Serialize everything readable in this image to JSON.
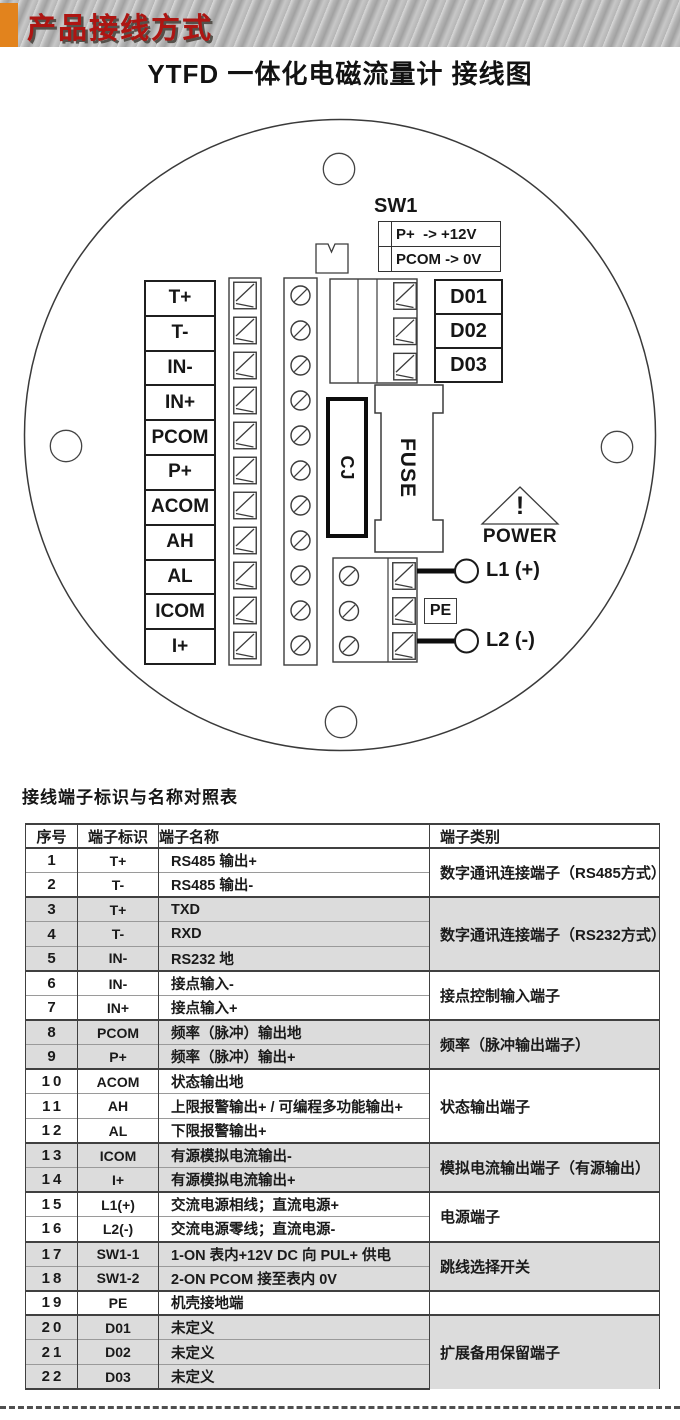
{
  "banner": {
    "title": "产品接线方式",
    "accent_color": "#e2831d",
    "title_color": "#ae1512"
  },
  "doc_title": "YTFD 一体化电磁流量计 接线图",
  "diagram": {
    "sw1": {
      "label": "SW1",
      "rows": [
        "P+  -> +12V",
        "PCOM -> 0V"
      ]
    },
    "left_terminals": [
      "T+",
      "T-",
      "IN-",
      "IN+",
      "PCOM",
      "P+",
      "ACOM",
      "AH",
      "AL",
      "ICOM",
      "I+"
    ],
    "relay_outputs": [
      "D01",
      "D02",
      "D03"
    ],
    "cj_label": "CJ",
    "fuse_label": "FUSE",
    "power_warning": {
      "exclamation": "!",
      "label": "POWER"
    },
    "power_terminals": {
      "l1": "L1 (+)",
      "pe": "PE",
      "l2": "L2 (-)"
    }
  },
  "table": {
    "heading": "接线端子标识与名称对照表",
    "columns": [
      "序号",
      "端子标识",
      "端子名称",
      "端子类别"
    ],
    "rows": [
      {
        "no": "1",
        "id": "T+",
        "name": "RS485 输出+"
      },
      {
        "no": "2",
        "id": "T-",
        "name": "RS485 输出-"
      },
      {
        "no": "3",
        "id": "T+",
        "name": "TXD"
      },
      {
        "no": "4",
        "id": "T-",
        "name": "RXD"
      },
      {
        "no": "5",
        "id": "IN-",
        "name": "RS232 地"
      },
      {
        "no": "6",
        "id": "IN-",
        "name": "接点输入-"
      },
      {
        "no": "7",
        "id": "IN+",
        "name": "接点输入+"
      },
      {
        "no": "8",
        "id": "PCOM",
        "name": "频率（脉冲）输出地"
      },
      {
        "no": "9",
        "id": "P+",
        "name": "频率（脉冲）输出+"
      },
      {
        "no": "10",
        "id": "ACOM",
        "name": "状态输出地"
      },
      {
        "no": "11",
        "id": "AH",
        "name": "上限报警输出+ / 可编程多功能输出+"
      },
      {
        "no": "12",
        "id": "AL",
        "name": "下限报警输出+"
      },
      {
        "no": "13",
        "id": "ICOM",
        "name": "有源模拟电流输出-"
      },
      {
        "no": "14",
        "id": "I+",
        "name": "有源模拟电流输出+"
      },
      {
        "no": "15",
        "id": "L1(+)",
        "name": "交流电源相线；直流电源+"
      },
      {
        "no": "16",
        "id": "L2(-)",
        "name": "交流电源零线；直流电源-"
      },
      {
        "no": "17",
        "id": "SW1-1",
        "name": "1-ON 表内+12V DC 向 PUL+ 供电"
      },
      {
        "no": "18",
        "id": "SW1-2",
        "name": "2-ON PCOM 接至表内 0V"
      },
      {
        "no": "19",
        "id": "PE",
        "name": "机壳接地端"
      },
      {
        "no": "20",
        "id": "D01",
        "name": "未定义"
      },
      {
        "no": "21",
        "id": "D02",
        "name": "未定义"
      },
      {
        "no": "22",
        "id": "D03",
        "name": "未定义"
      }
    ],
    "groups": [
      {
        "start": 1,
        "end": 2,
        "category": "数字通讯连接端子（RS485方式）",
        "shaded": false
      },
      {
        "start": 3,
        "end": 5,
        "category": "数字通讯连接端子（RS232方式）",
        "shaded": true
      },
      {
        "start": 6,
        "end": 7,
        "category": "接点控制输入端子",
        "shaded": false
      },
      {
        "start": 8,
        "end": 9,
        "category": "频率（脉冲输出端子）",
        "shaded": true
      },
      {
        "start": 10,
        "end": 12,
        "category": "状态输出端子",
        "shaded": false
      },
      {
        "start": 13,
        "end": 14,
        "category": "模拟电流输出端子（有源输出）",
        "shaded": true
      },
      {
        "start": 15,
        "end": 16,
        "category": "电源端子",
        "shaded": false
      },
      {
        "start": 17,
        "end": 18,
        "category": "跳线选择开关",
        "shaded": true
      },
      {
        "start": 19,
        "end": 19,
        "category": "",
        "shaded": false
      },
      {
        "start": 20,
        "end": 22,
        "category": "扩展备用保留端子",
        "shaded": true
      }
    ]
  }
}
